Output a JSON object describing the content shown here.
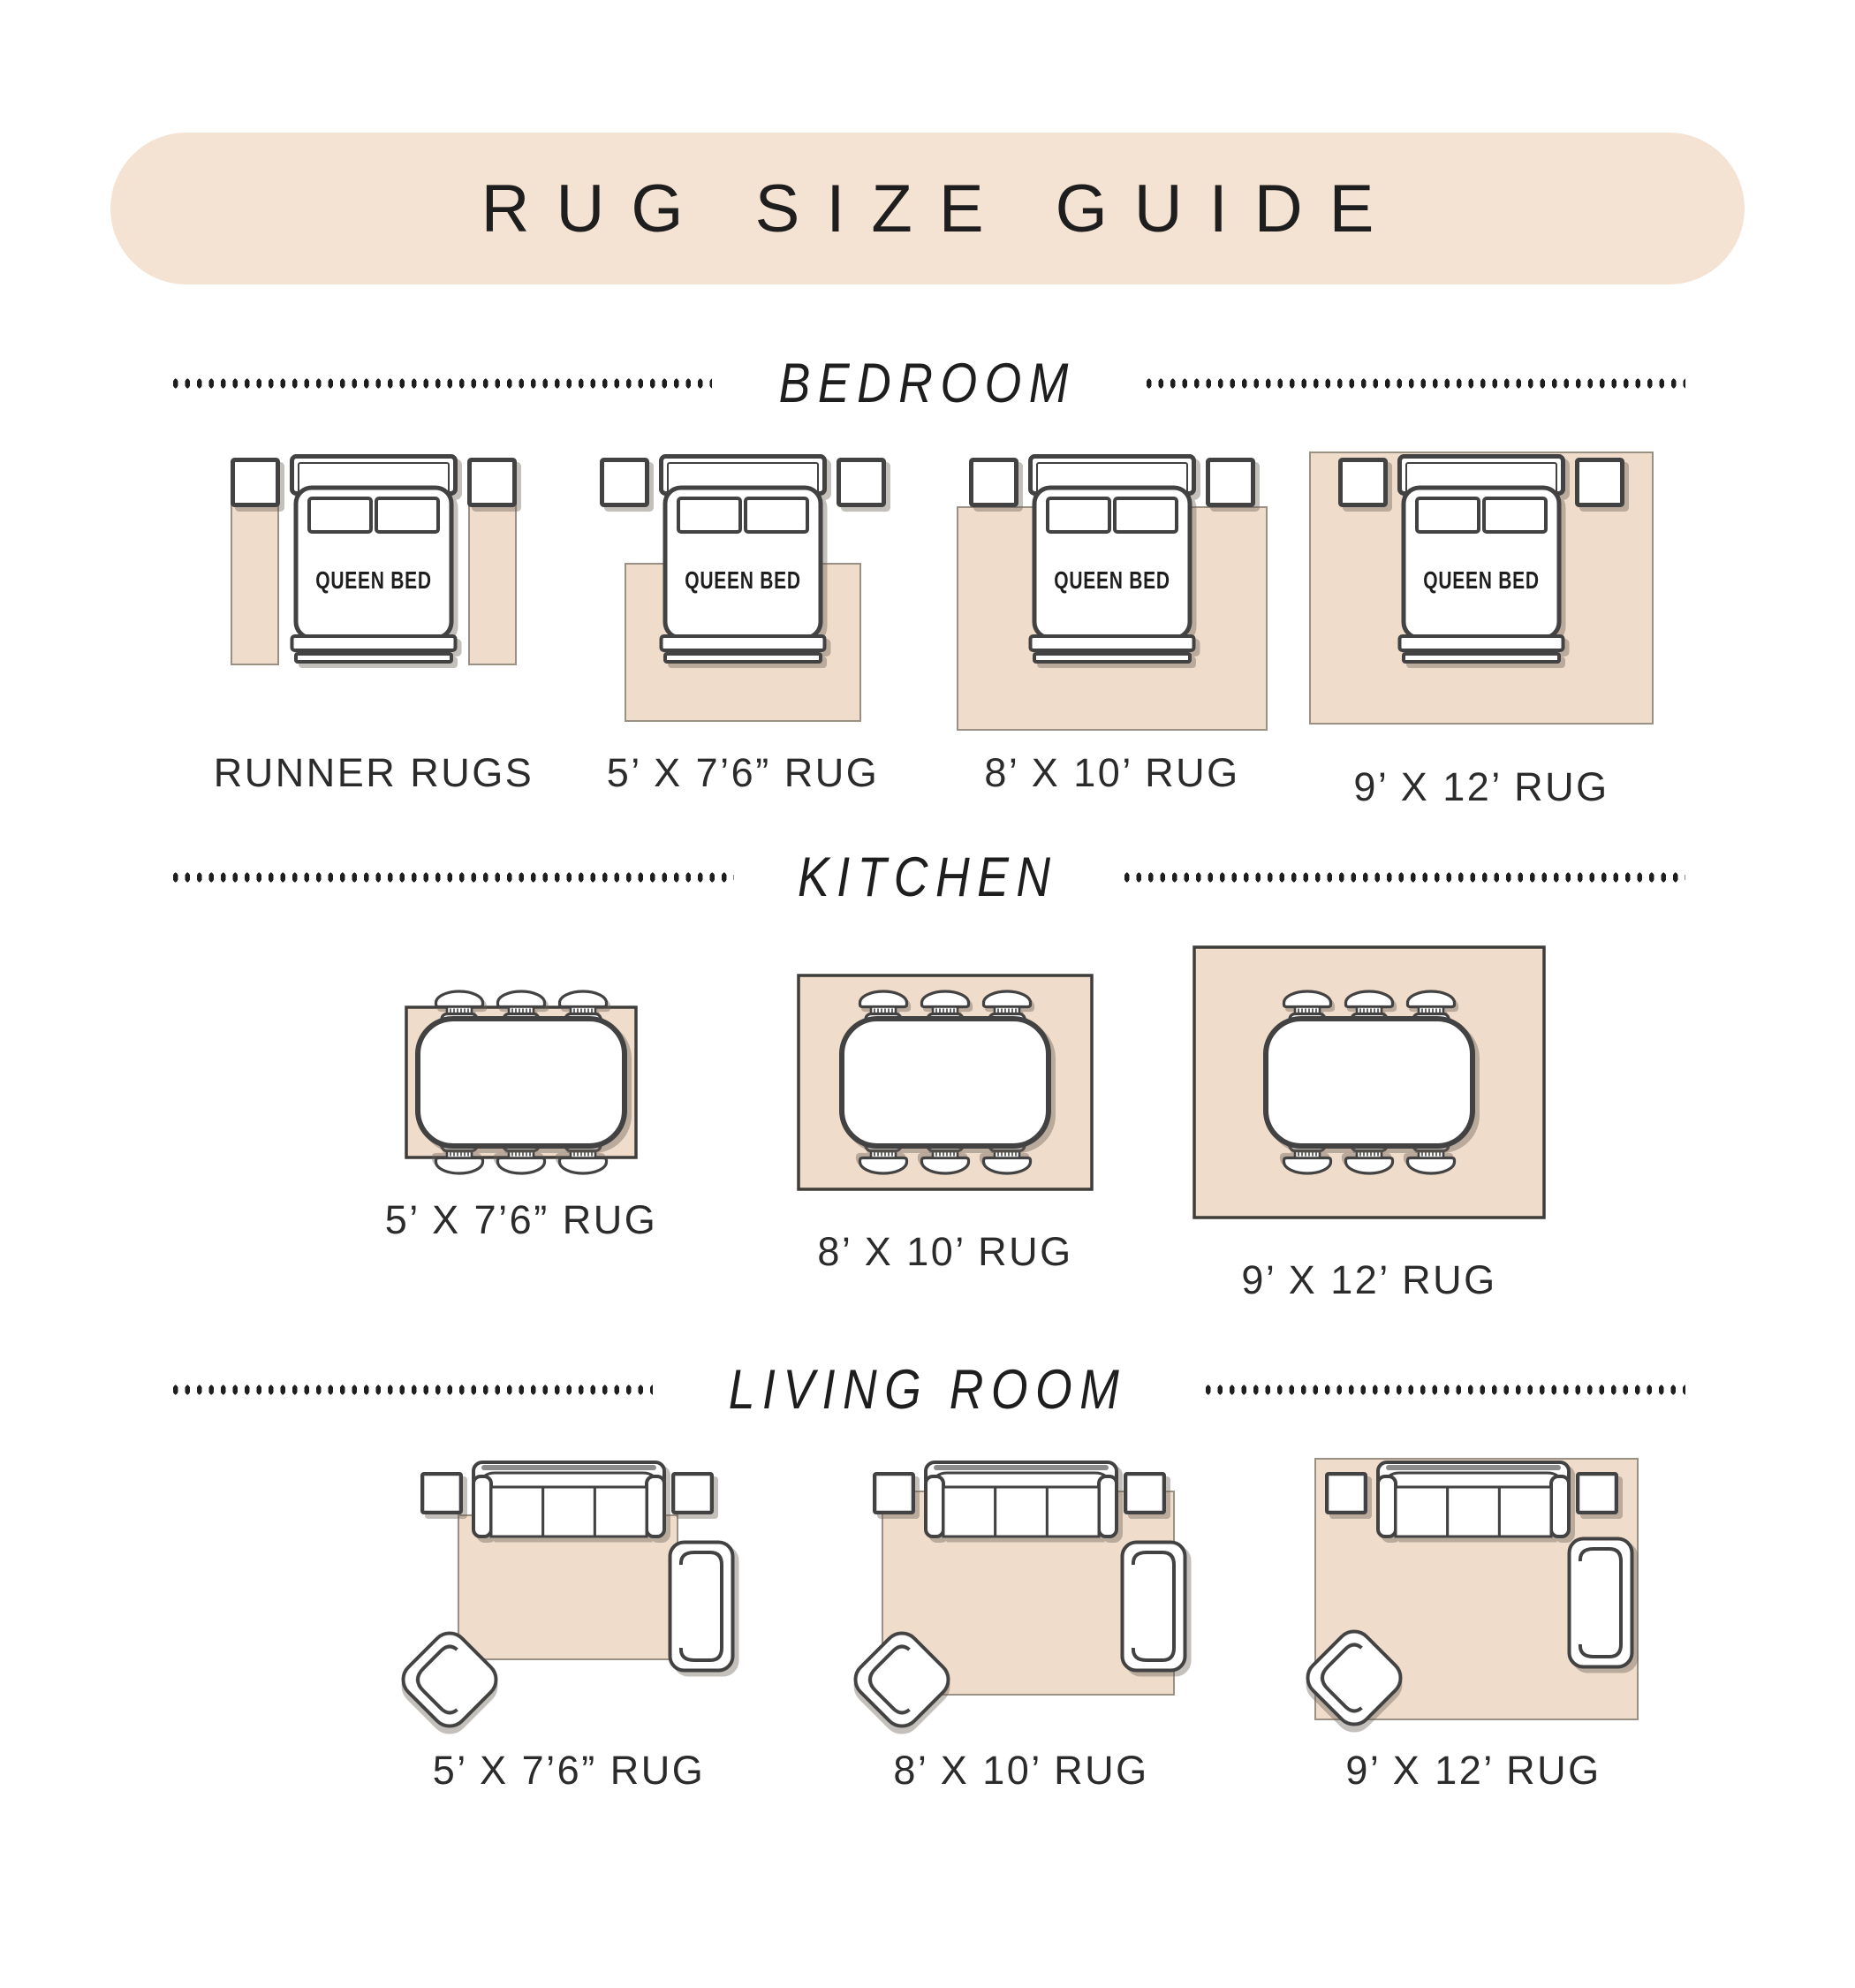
{
  "title": "RUG SIZE GUIDE",
  "bed_label": "QUEEN BED",
  "colors": {
    "banner_bg": "#f4e3d3",
    "rug_fill": "#f0dccb",
    "rug_border": "#9a9083",
    "kitchen_rug_border": "#3f3d3a",
    "outline": "#424242",
    "ink": "#1e1e1e",
    "shadow": "rgba(104,96,84,0.4)",
    "text": "#2b2b2b"
  },
  "sections": [
    {
      "id": "bedroom",
      "title": "BEDROOM",
      "items": [
        {
          "label": "RUNNER RUGS",
          "rug": "runner"
        },
        {
          "label": "5’ X 7’6” RUG",
          "rug": "5x7_6"
        },
        {
          "label": "8’ X 10’ RUG",
          "rug": "8x10"
        },
        {
          "label": "9’ X 12’ RUG",
          "rug": "9x12"
        }
      ]
    },
    {
      "id": "kitchen",
      "title": "KITCHEN",
      "items": [
        {
          "label": "5’ X 7’6” RUG",
          "rug": "5x7_6"
        },
        {
          "label": "8’ X 10’ RUG",
          "rug": "8x10"
        },
        {
          "label": "9’ X 12’ RUG",
          "rug": "9x12"
        }
      ]
    },
    {
      "id": "living-room",
      "title": "LIVING ROOM",
      "items": [
        {
          "label": "5’ X 7’6” RUG",
          "rug": "5x7_6"
        },
        {
          "label": "8’ X 10’ RUG",
          "rug": "8x10"
        },
        {
          "label": "9’ X 12’ RUG",
          "rug": "9x12"
        }
      ]
    }
  ]
}
